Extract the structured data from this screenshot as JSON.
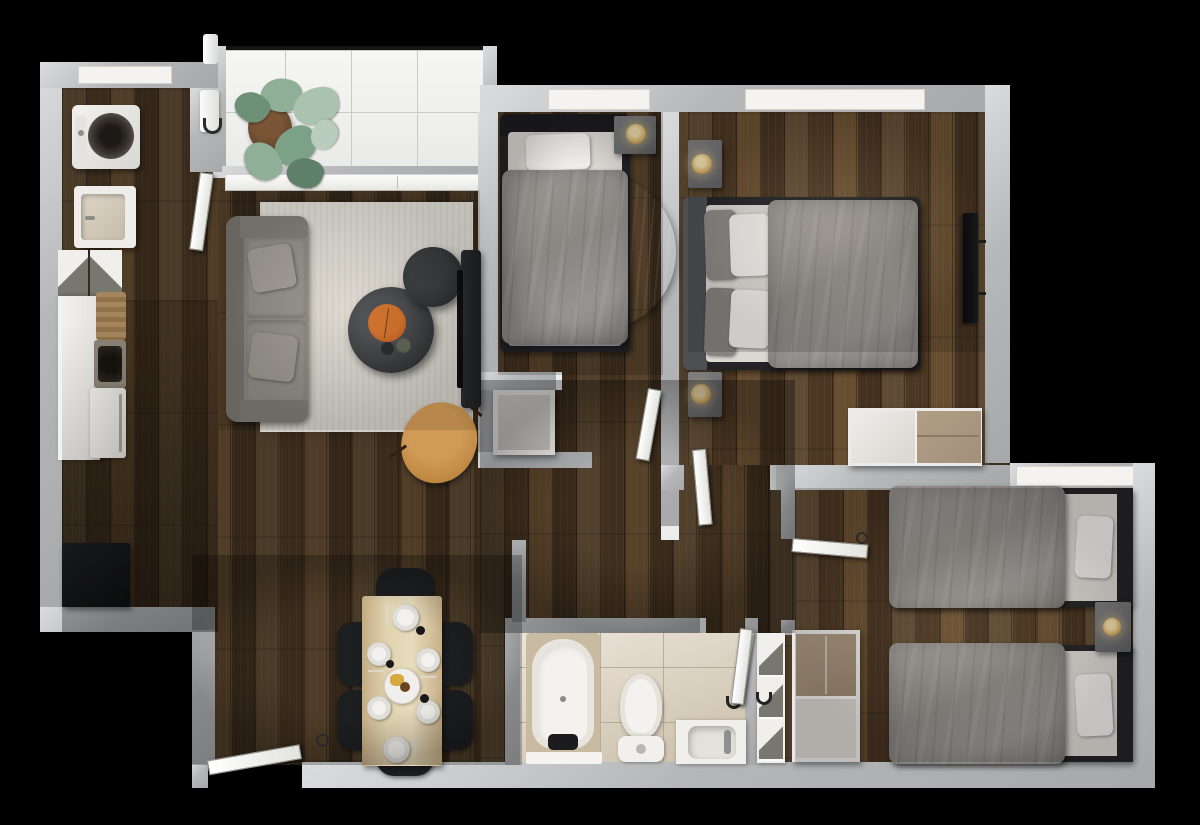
{
  "meta": {
    "type": "3d-floor-plan-render",
    "view": "top-down",
    "description": "Photorealistic top-down render of a three-bedroom apartment with dark wood floors"
  },
  "colors": {
    "bg": "#000000",
    "wall": "#b5b7b9",
    "sill": "#f4f3f0",
    "wood": "#47341f",
    "balconyTile": "#eff0ee",
    "bathTile": "#d7cab4",
    "rug": "#d9d6cf",
    "rugBlue": "#5c6b76",
    "sofa": "#8b8781",
    "duvet": "#8f8c89",
    "pillow": "#efedea",
    "bedFrame": "#232327",
    "nightstand": "#6f7073",
    "lamp": "#d9b36a",
    "coffeeTable": "#2e3033",
    "tray": "#c05a17",
    "armchair": "#c08a45",
    "diningTable": "#d8c5a2",
    "chair": "#1d1e20",
    "plate": "#f2f1ee",
    "plant": "#8aab91",
    "pot": "#6b4a30",
    "closetTan": "#a3907a",
    "fixture": "#f4f2ee"
  },
  "rooms": [
    {
      "id": "balcony",
      "label": "Balcony",
      "furniture": [
        "monstera plant",
        "black railing",
        "white tile floor"
      ]
    },
    {
      "id": "kitchen",
      "label": "Kitchen",
      "furniture": [
        "washing machine",
        "laundry sink",
        "open dish cabinet",
        "white counter",
        "cutting board",
        "sink",
        "oven",
        "black sideboard"
      ]
    },
    {
      "id": "living-room",
      "label": "Living room",
      "furniture": [
        "gray sofa",
        "throw pillows",
        "light area rug",
        "round coffee table",
        "orange serving tray",
        "round ottoman table",
        "tv console",
        "tan armchair"
      ]
    },
    {
      "id": "dining-area",
      "label": "Dining area",
      "furniture": [
        "wood dining table",
        "six black chairs",
        "six place settings",
        "center platter"
      ]
    },
    {
      "id": "bedroom-1",
      "label": "Bedroom 1",
      "furniture": [
        "single bed",
        "round blue rug",
        "nightstand",
        "table lamp"
      ]
    },
    {
      "id": "bedroom-2",
      "label": "Bedroom 2",
      "furniture": [
        "double bed",
        "two nightstands",
        "table lamps",
        "wall tv",
        "wardrobe"
      ]
    },
    {
      "id": "twin-bedroom",
      "label": "Twin bedroom",
      "furniture": [
        "twin bed upper",
        "twin bed lower",
        "shared nightstand",
        "lamp",
        "closet",
        "linen shelf"
      ]
    },
    {
      "id": "bathroom",
      "label": "Bathroom",
      "furniture": [
        "bathtub",
        "toilet",
        "vanity sink",
        "towel",
        "bath mat"
      ]
    },
    {
      "id": "hallway",
      "label": "Hallway",
      "furniture": [
        "white hall cabinet"
      ]
    }
  ],
  "doors": [
    {
      "id": "entry-door",
      "label": "Entrance door"
    },
    {
      "id": "kitchen-door",
      "label": "Kitchen door"
    },
    {
      "id": "bedroom-1-door",
      "label": "Bedroom 1 door"
    },
    {
      "id": "bedroom-2-door",
      "label": "Bedroom 2 door"
    },
    {
      "id": "twin-bedroom-door",
      "label": "Twin bedroom door"
    },
    {
      "id": "bathroom-door",
      "label": "Bathroom door"
    }
  ],
  "windows": [
    {
      "id": "kitchen-window"
    },
    {
      "id": "balcony-sliding-door"
    },
    {
      "id": "bedroom-1-window"
    },
    {
      "id": "bedroom-2-window"
    },
    {
      "id": "twin-bedroom-window"
    }
  ]
}
